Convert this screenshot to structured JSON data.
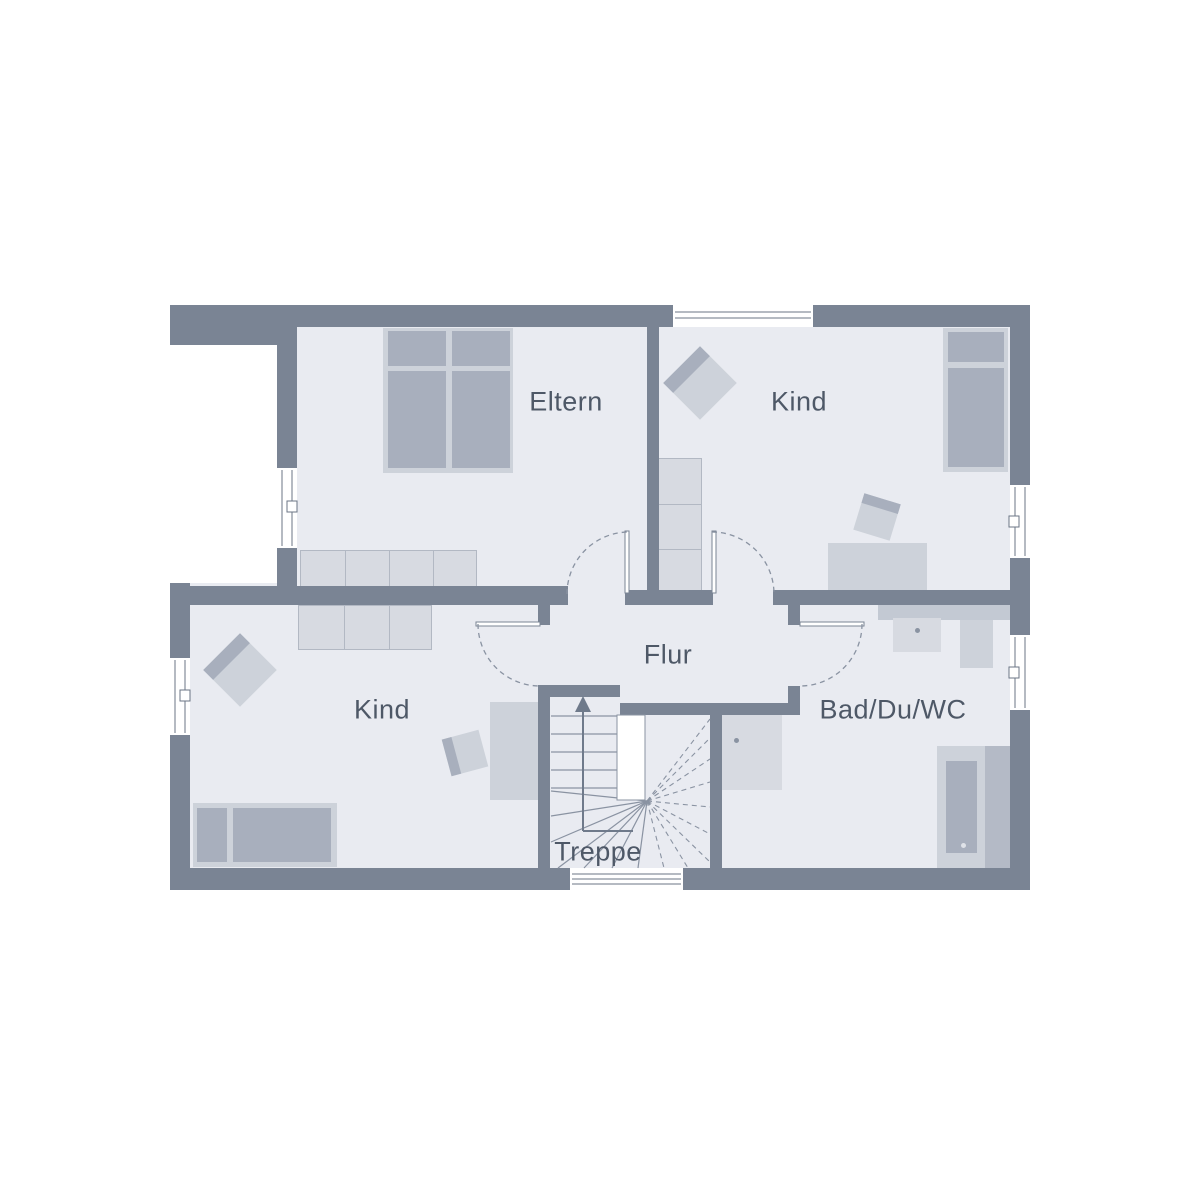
{
  "plan": {
    "rooms": {
      "eltern": {
        "label": "Eltern"
      },
      "kind_top": {
        "label": "Kind"
      },
      "kind_bottom": {
        "label": "Kind"
      },
      "flur": {
        "label": "Flur"
      },
      "bad": {
        "label": "Bad/Du/WC"
      },
      "treppe": {
        "label": "Treppe"
      }
    }
  },
  "colors": {
    "background": "#ffffff",
    "wall": "#7a8494",
    "floor": "#e9ebf1",
    "furnLight": "#cdd2da",
    "furnMed": "#a8afbd",
    "cabinet": "#d7dae1",
    "cabinetBorder": "#b2b8c3",
    "counter": "#c3c9d3",
    "ledge": "#b4bac6",
    "line": "#8a93a2",
    "labelText": "#4e5867"
  }
}
